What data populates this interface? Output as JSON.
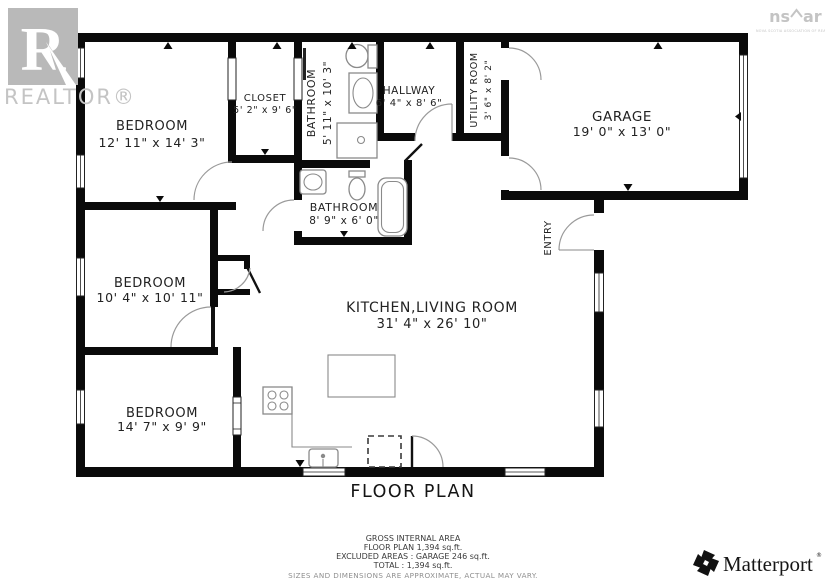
{
  "title": "FLOOR PLAN",
  "rooms": [
    {
      "name": "BEDROOM",
      "dims": "12' 11\" x 14' 3\""
    },
    {
      "name": "CLOSET",
      "dims": "5' 2\" x 9' 6\""
    },
    {
      "name": "BATHROOM",
      "dims": "5' 11\" x 10' 3\""
    },
    {
      "name": "HALLWAY",
      "dims": "6' 4\" x 8' 6\""
    },
    {
      "name": "UTILITY ROOM",
      "dims": "3' 6\" x 8' 2\""
    },
    {
      "name": "GARAGE",
      "dims": "19' 0\" x 13' 0\""
    },
    {
      "name": "BATHROOM",
      "dims": "8' 9\" x 6' 0\""
    },
    {
      "name": "BEDROOM",
      "dims": "10' 4\" x 10' 11\""
    },
    {
      "name": "KITCHEN,LIVING ROOM",
      "dims": "31' 4\" x 26' 10\""
    },
    {
      "name": "BEDROOM",
      "dims": "14' 7\" x 9' 9\""
    },
    {
      "name": "ENTRY",
      "dims": ""
    }
  ],
  "footer": {
    "line1": "GROSS INTERNAL AREA",
    "line2": "FLOOR PLAN 1,394 sq.ft.",
    "line3": "EXCLUDED AREAS :  GARAGE 246 sq.ft.",
    "line4": "TOTAL :  1,394 sq.ft.",
    "disclaimer": "SIZES AND DIMENSIONS ARE APPROXIMATE, ACTUAL MAY VARY."
  },
  "logos": {
    "realtor": {
      "letter": "R",
      "label": "REALTOR®"
    },
    "nsar": {
      "part1": "ns",
      "part2": "ar",
      "subtext": "NOVA SCOTIA ASSOCIATION OF REALTORS"
    },
    "matterport": {
      "label": "Matterport",
      "mark": "®"
    }
  },
  "colors": {
    "wall": "#0a0a0a",
    "fixture_line": "#8a8a8a",
    "logo_gray": "#c4c4c4",
    "text": "#222222"
  }
}
